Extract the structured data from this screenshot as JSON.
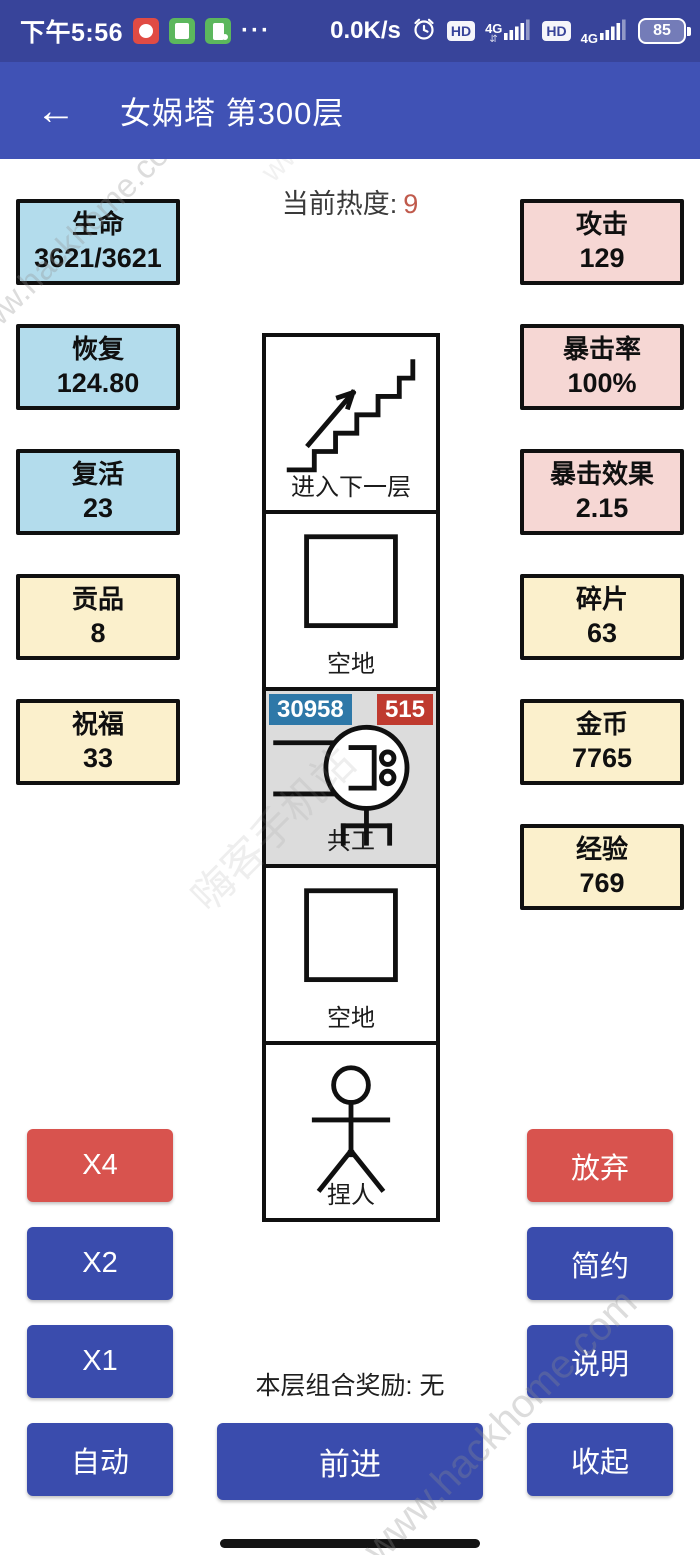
{
  "status_bar": {
    "time": "下午5:56",
    "ellipsis": "···",
    "net_speed": "0.0K/s",
    "hd_label": "HD",
    "signal_label": "4G",
    "signal_arrows": "⇵",
    "battery_percent": "85"
  },
  "app_bar": {
    "back_icon": "←",
    "title": "女娲塔 第300层"
  },
  "heat": {
    "label": "当前热度:",
    "value": "9"
  },
  "stats_left": [
    {
      "label": "生命",
      "value": "3621/3621"
    },
    {
      "label": "恢复",
      "value": "124.80"
    },
    {
      "label": "复活",
      "value": "23"
    },
    {
      "label": "贡品",
      "value": "8"
    },
    {
      "label": "祝福",
      "value": "33"
    }
  ],
  "stats_right": [
    {
      "label": "攻击",
      "value": "129"
    },
    {
      "label": "暴击率",
      "value": "100%"
    },
    {
      "label": "暴击效果",
      "value": "2.15"
    },
    {
      "label": "碎片",
      "value": "63"
    },
    {
      "label": "金币",
      "value": "7765"
    },
    {
      "label": "经验",
      "value": "769"
    }
  ],
  "tower_cells": {
    "stairs": {
      "label": "进入下一层"
    },
    "empty_top": {
      "label": "空地"
    },
    "monster": {
      "label": "共工",
      "hp": "30958",
      "attack": "515"
    },
    "empty_bottom": {
      "label": "空地"
    },
    "player": {
      "label": "捏人"
    }
  },
  "buttons_left": [
    {
      "label": "X4"
    },
    {
      "label": "X2"
    },
    {
      "label": "X1"
    },
    {
      "label": "自动"
    }
  ],
  "buttons_right": [
    {
      "label": "放弃"
    },
    {
      "label": "简约"
    },
    {
      "label": "说明"
    },
    {
      "label": "收起"
    }
  ],
  "bottom": {
    "combo_reward": "本层组合奖励: 无",
    "advance": "前进"
  },
  "watermark": {
    "text": "www.hackhome.com",
    "cn": "嗨客手机站"
  },
  "colors": {
    "status_bar": "#38449A",
    "app_bar": "#4052B5",
    "button_blue": "#3A4CAD",
    "button_red": "#D8534E",
    "hp_badge": "#2E78A8",
    "attack_badge": "#BF3A2F",
    "stat_blue": "#B3DCEC",
    "stat_pink": "#F6D7D4",
    "stat_yellow": "#FBF0CC",
    "heat_value": "#C05A4C",
    "monster_cell_bg": "#DCDCDC"
  }
}
